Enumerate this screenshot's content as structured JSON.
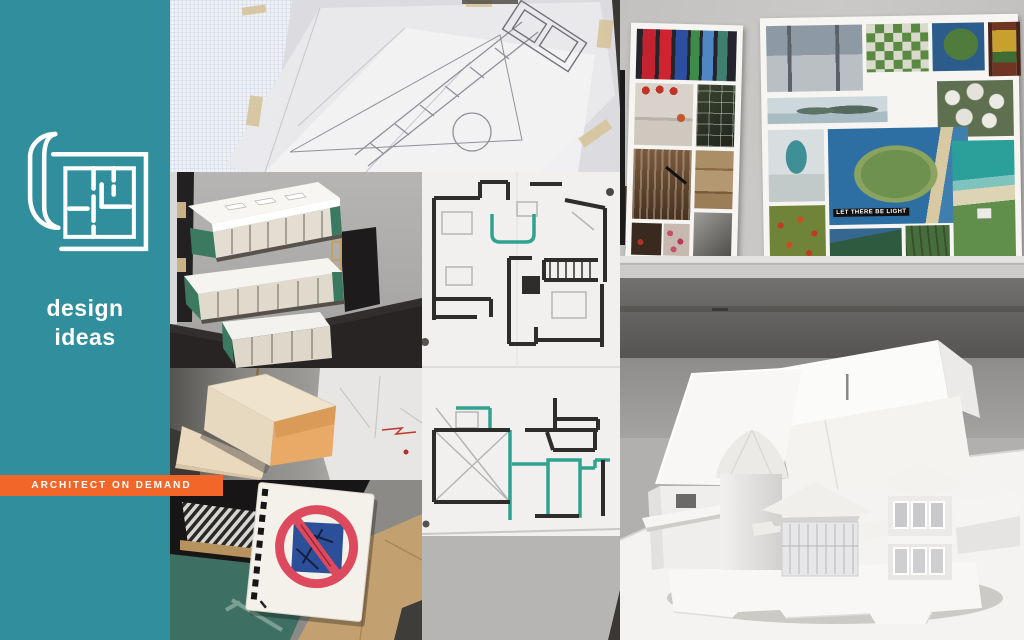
{
  "theme": {
    "colors": {
      "teal": "#318f9d",
      "orange": "#f2662a",
      "banner-text": "#ffffff",
      "plan-teal": "#2fa390",
      "model-green": "#3b7a60"
    }
  },
  "sidebar": {
    "logo_icon": "blueprint-roll-icon",
    "title_line1": "design",
    "title_line2": "ideas",
    "banner_label": "ARCHITECT ON DEMAND"
  },
  "collage": {
    "moodboard_caption": "LET THERE BE LIGHT",
    "photos": [
      {
        "id": "sketch-tracing-paper",
        "description": "Pencil floor-plan sketch on tracing paper over graph paper, taped at the edges"
      },
      {
        "id": "stacked-models",
        "description": "Three stacked white study models with green end walls on a dark desk"
      },
      {
        "id": "marker-floor-plans",
        "description": "Two hand-drawn floor plans in black marker with teal highlights"
      },
      {
        "id": "cardboard-model",
        "description": "Cardboard and foam-board massing model with orange interior faces"
      },
      {
        "id": "notebook-no-sign",
        "description": "Spiral sketchbook with a red prohibition symbol over a blue square, on a green cutting mat and cardboard"
      },
      {
        "id": "mood-boards",
        "description": "Two mood boards of interior and coastal photos leaning on a shelf"
      },
      {
        "id": "white-study-model",
        "description": "White paper study model of a house with a cylindrical tower on a white table"
      }
    ]
  }
}
